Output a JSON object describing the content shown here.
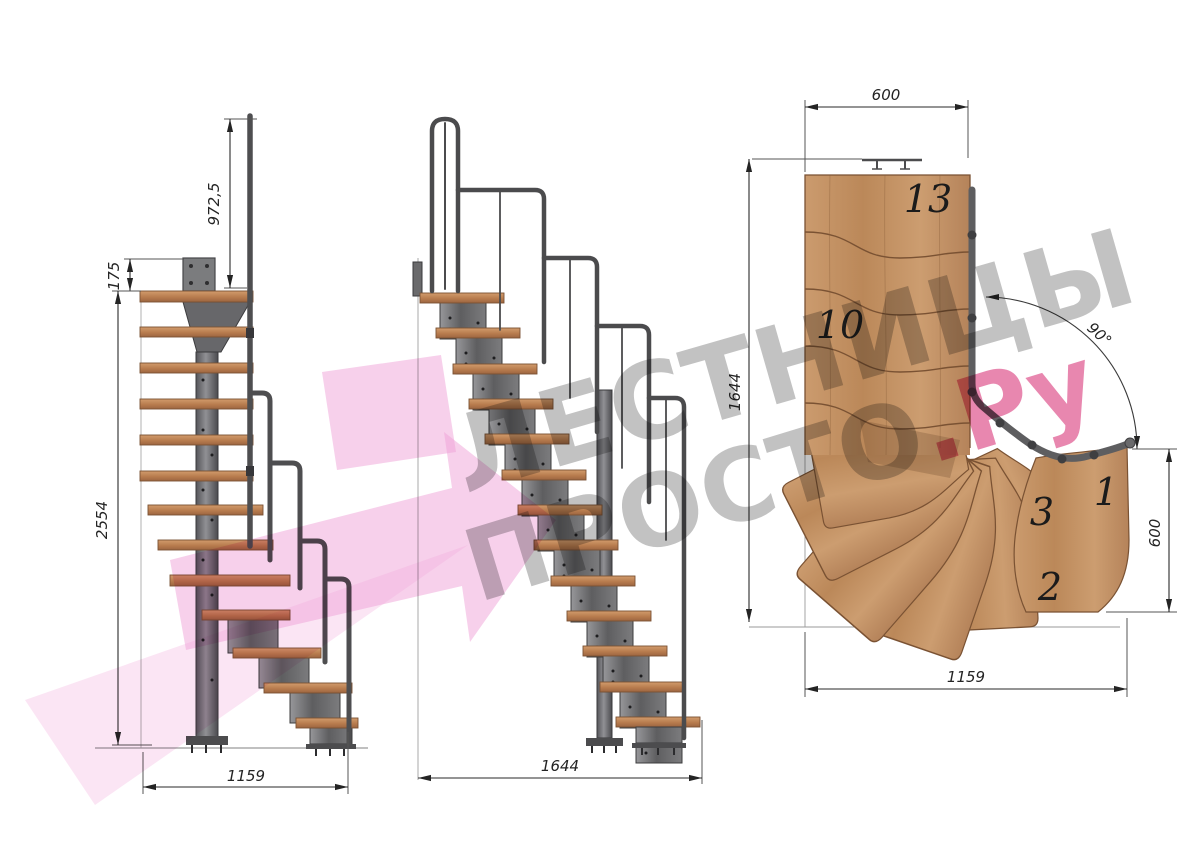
{
  "title": "Modular staircase technical drawing, three views",
  "watermark": {
    "line1": "ЛЕСТНИЦЫ",
    "line2_gray": "ПРОСТО",
    "line2_pink": ".Ру",
    "gray_color": "#6e6e6e",
    "pink_text_color": "#d6246e",
    "pink_arrow_color": "#f0a2d8"
  },
  "views": {
    "side": {
      "label": "side elevation",
      "dims": {
        "rail_post_height": "972,5",
        "bracket_height": "175",
        "total_height": "2554",
        "depth": "1159"
      }
    },
    "front": {
      "label": "front elevation",
      "dims": {
        "run": "1644"
      }
    },
    "plan": {
      "label": "top plan view",
      "dims": {
        "flight_width": "600",
        "depth": "1644",
        "exit_width": "600",
        "width": "1159",
        "turn_angle": "90°"
      },
      "steps": {
        "s13": "13",
        "s10": "10",
        "s3": "3",
        "s2": "2",
        "s1": "1"
      }
    }
  },
  "colors": {
    "wood": "#c2916a",
    "wood_edge": "#7a5233",
    "metal": "#6b6b6d",
    "metal_dark": "#3c3c3e",
    "dim_lines": "#2a2a2a"
  }
}
